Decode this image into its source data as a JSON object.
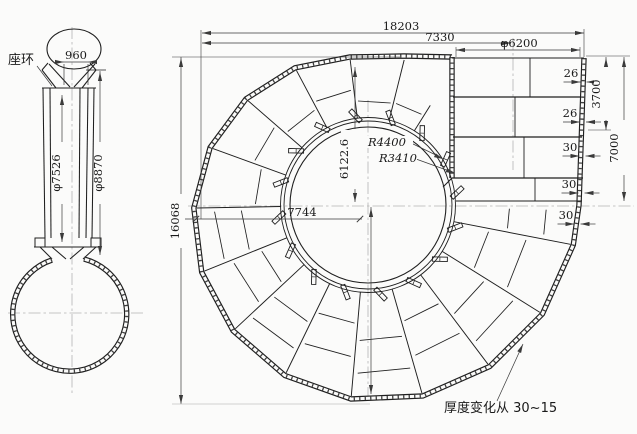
{
  "drawing": {
    "side_view": {
      "stay_ring_label": "座环",
      "top_width": "960",
      "inner_diameter": "φ7526",
      "outer_diameter": "φ8870"
    },
    "plan_view": {
      "total_width": "18203",
      "inlet_center_offset": "7330",
      "inlet_diameter": "φ6200",
      "total_height": "16068",
      "top_to_center": "6122.6",
      "left_to_center": "7744",
      "outer_radius_label": "R4400",
      "inner_radius_label": "R3410",
      "upper_depth": "3700",
      "half_depth": "7000",
      "plate_thickness": [
        "26",
        "26",
        "30",
        "30",
        "30"
      ],
      "thickness_note": "厚度变化从 30~15"
    }
  }
}
